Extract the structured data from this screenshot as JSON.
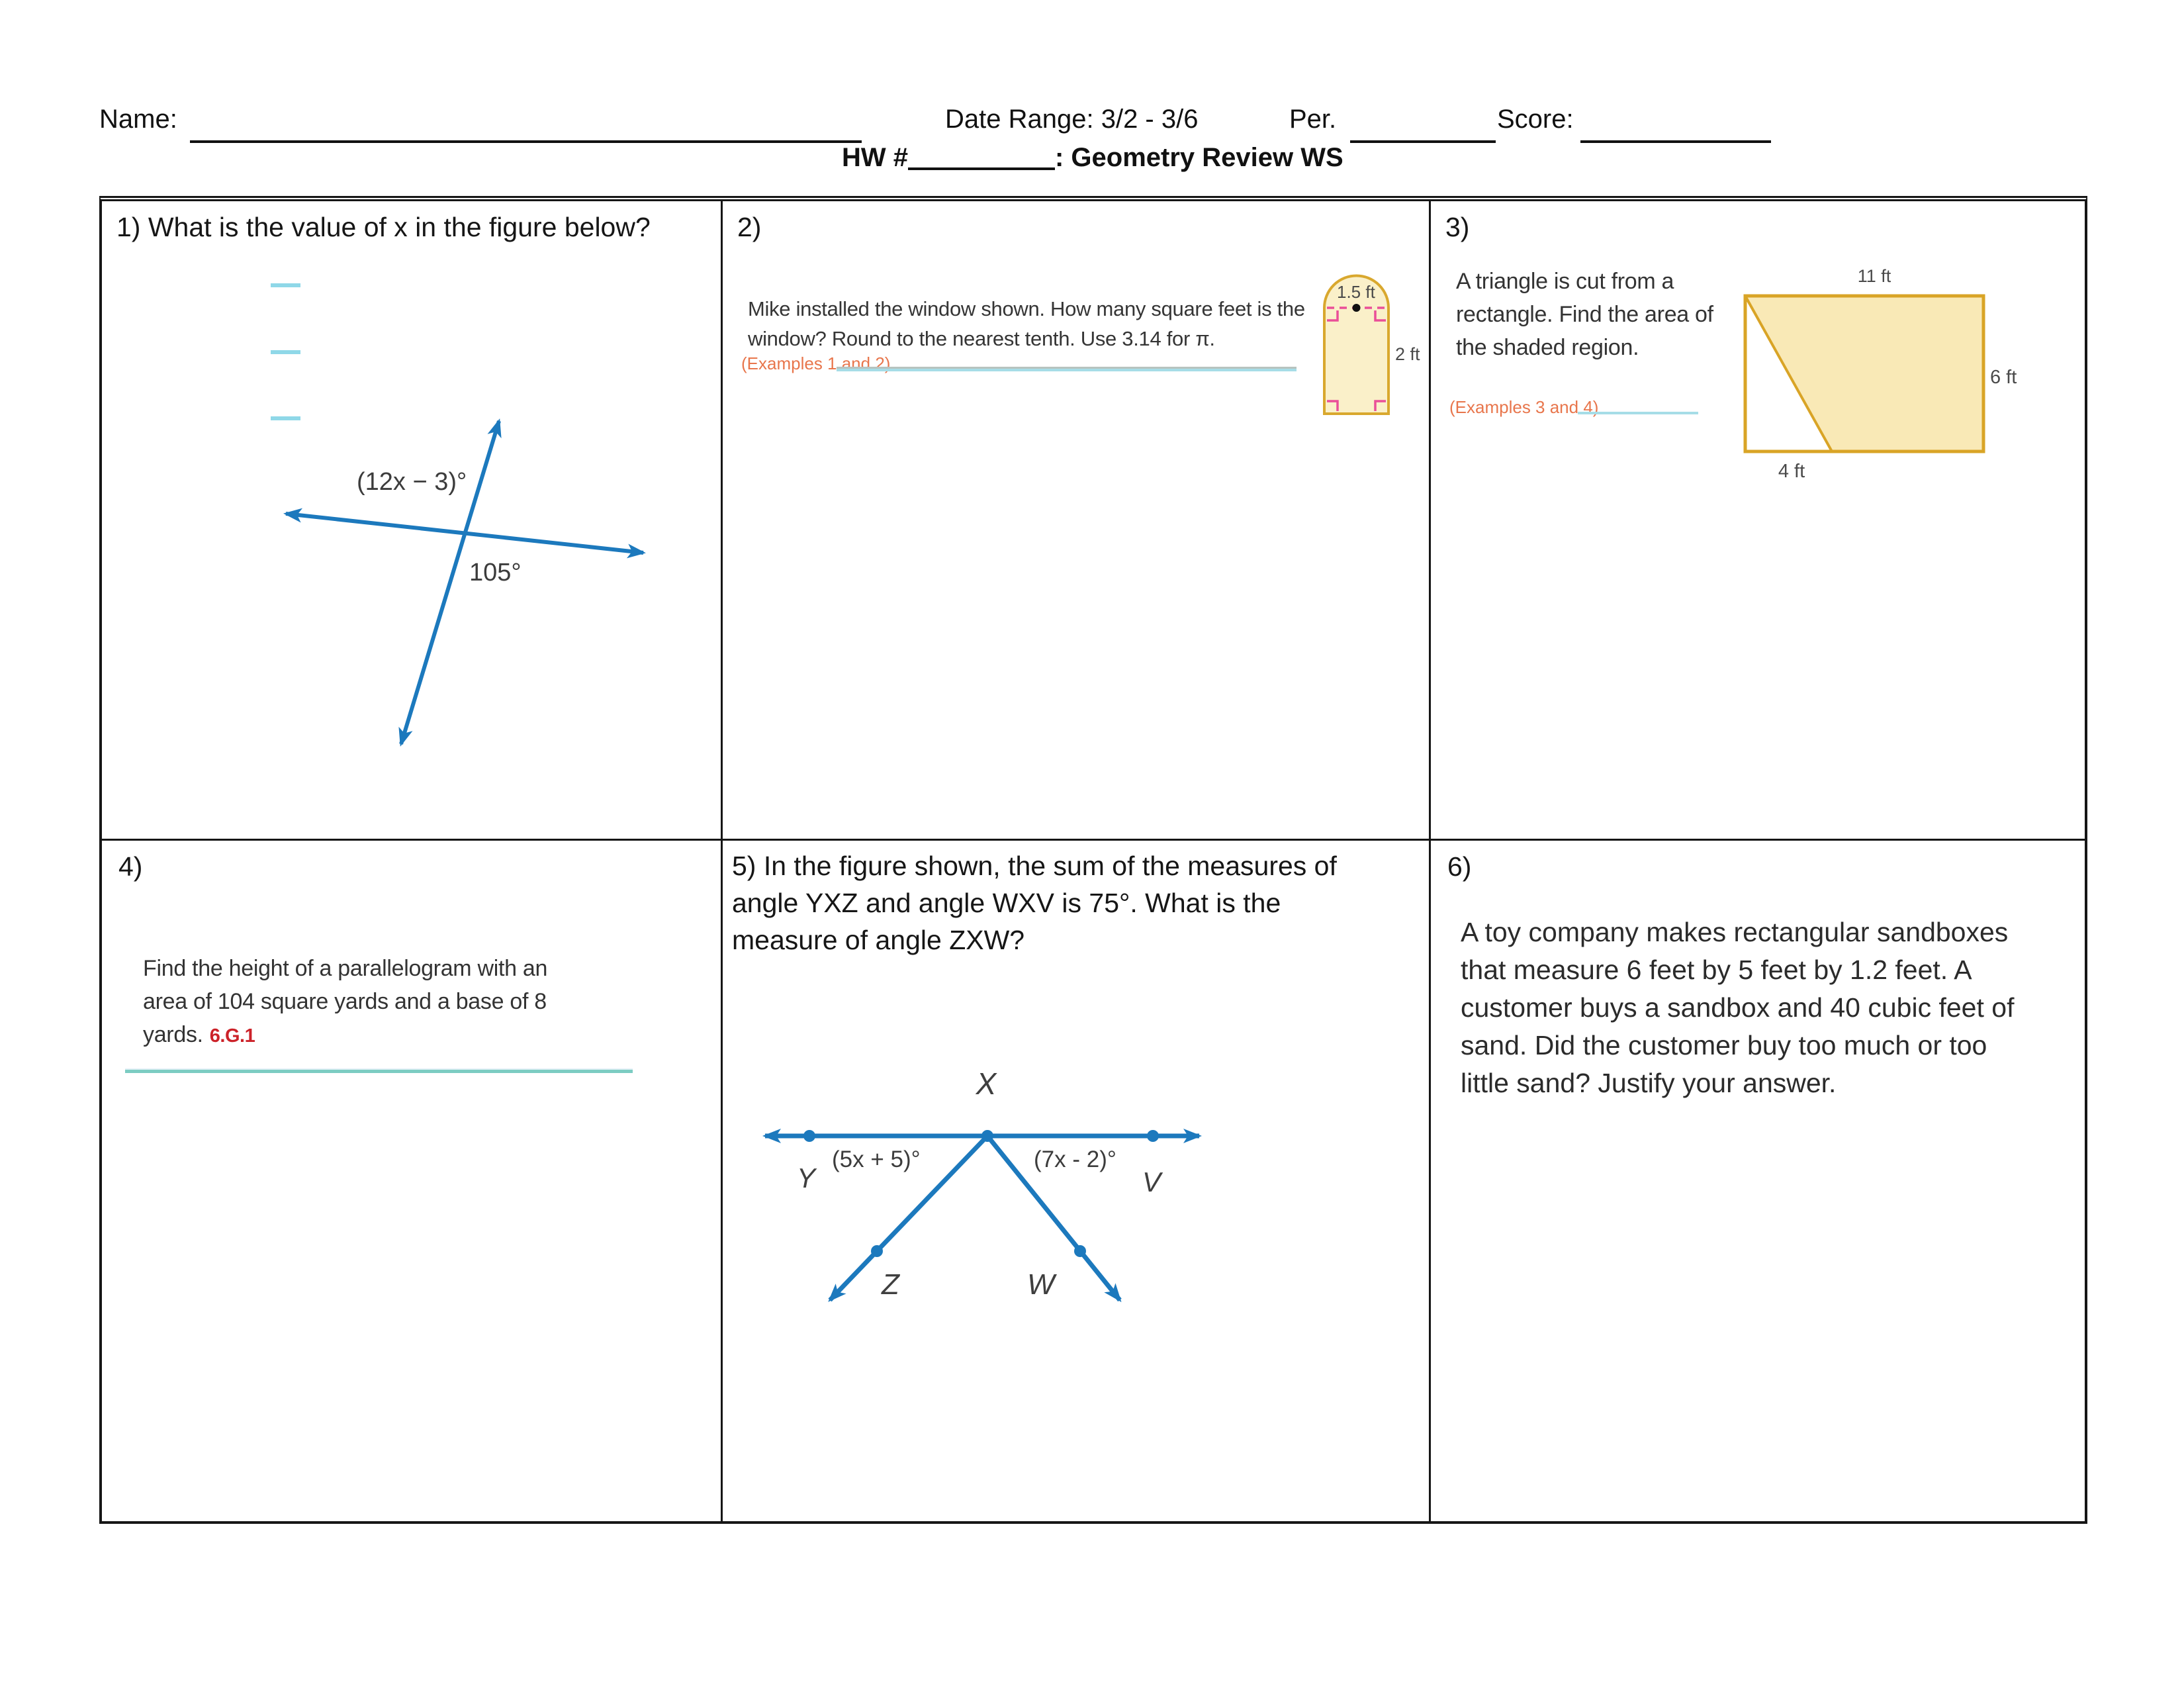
{
  "header": {
    "name_label": "Name:",
    "date_range": "Date Range: 3/2 - 3/6",
    "per_label": "Per.",
    "score_label": "Score:",
    "hw_prefix": "HW #",
    "hw_title": ": Geometry Review WS"
  },
  "problems": {
    "p1": {
      "heading": "1) What is the value of x in the figure below?",
      "figure": {
        "angle_expression": "(12x − 3)°",
        "angle_value": "105°"
      }
    },
    "p2": {
      "number": "2)",
      "text": "Mike installed the window shown. How many square feet is the window? Round to the nearest tenth. Use 3.14 for π.",
      "examples_ref": "(Examples 1 and 2)",
      "figure": {
        "width_label": "1.5 ft",
        "height_label": "2 ft"
      }
    },
    "p3": {
      "number": "3)",
      "text": "A triangle is cut from a rectangle. Find the area of the shaded region.",
      "examples_ref": "(Examples 3 and 4)",
      "figure": {
        "top_label": "11 ft",
        "right_label": "6 ft",
        "bottom_label": "4 ft"
      }
    },
    "p4": {
      "number": "4)",
      "text": "Find the height of a parallelogram with an area of 104 square yards and a base of 8 yards.",
      "standard": "6.G.1"
    },
    "p5": {
      "heading": "5) In the figure shown, the sum of the measures of angle YXZ and angle WXV is 75°.  What is the measure of angle ZXW?",
      "figure": {
        "point_x": "X",
        "point_y": "Y",
        "point_v": "V",
        "point_z": "Z",
        "point_w": "W",
        "angle_left": "(5x + 5)°",
        "angle_right": "(7x - 2)°"
      }
    },
    "p6": {
      "number": "6)",
      "text": "A toy company makes rectangular sandboxes that measure 6 feet by 5 feet by 1.2 feet. A customer buys a sandbox and 40 cubic feet of sand. Did the customer buy too much or too little sand? Justify your answer."
    }
  },
  "colors": {
    "figure_blue": "#1c79bd",
    "teal_line": "#a6dde7",
    "teal_line_dark": "#7cccc2",
    "cyan_dash": "#8fd8e8",
    "orange_ref": "#e8764c",
    "red_standard": "#cc2229",
    "shape_fill": "#f9e9b6",
    "shape_stroke": "#d9a426",
    "window_fill": "#faf0c9",
    "pink_marks": "#ea4f98"
  }
}
